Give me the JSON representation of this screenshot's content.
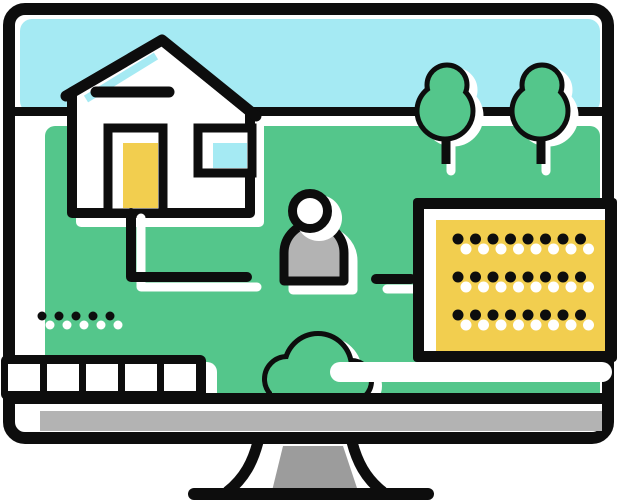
{
  "colors": {
    "outline": "#0d0d0d",
    "white": "#ffffff",
    "sky": "#a5eaf3",
    "grass": "#54c68b",
    "accent_yellow": "#f2ce4f",
    "gray_light": "#b3b3b3",
    "gray_dark": "#9c9c9c",
    "background": "#ffffff"
  },
  "scene": {
    "left_dots": {
      "black_count": 5,
      "white_count": 5,
      "start_x": 42,
      "row_ys": [
        316
      ],
      "step": 17,
      "radius": 4.5,
      "white_dx": 8,
      "white_dy": 9
    },
    "text_panel_dots": {
      "black_count": 8,
      "white_count": 8,
      "start_x": 458,
      "row_ys": [
        239,
        277,
        315
      ],
      "step": 17.5,
      "radius": 5.5,
      "white_dx": 8,
      "white_dy": 10
    },
    "film_strip": {
      "cell_count": 5,
      "first_x": 8,
      "cell_width": 32,
      "cell_gap": 39,
      "cell_y": 364,
      "cell_height": 27
    }
  }
}
